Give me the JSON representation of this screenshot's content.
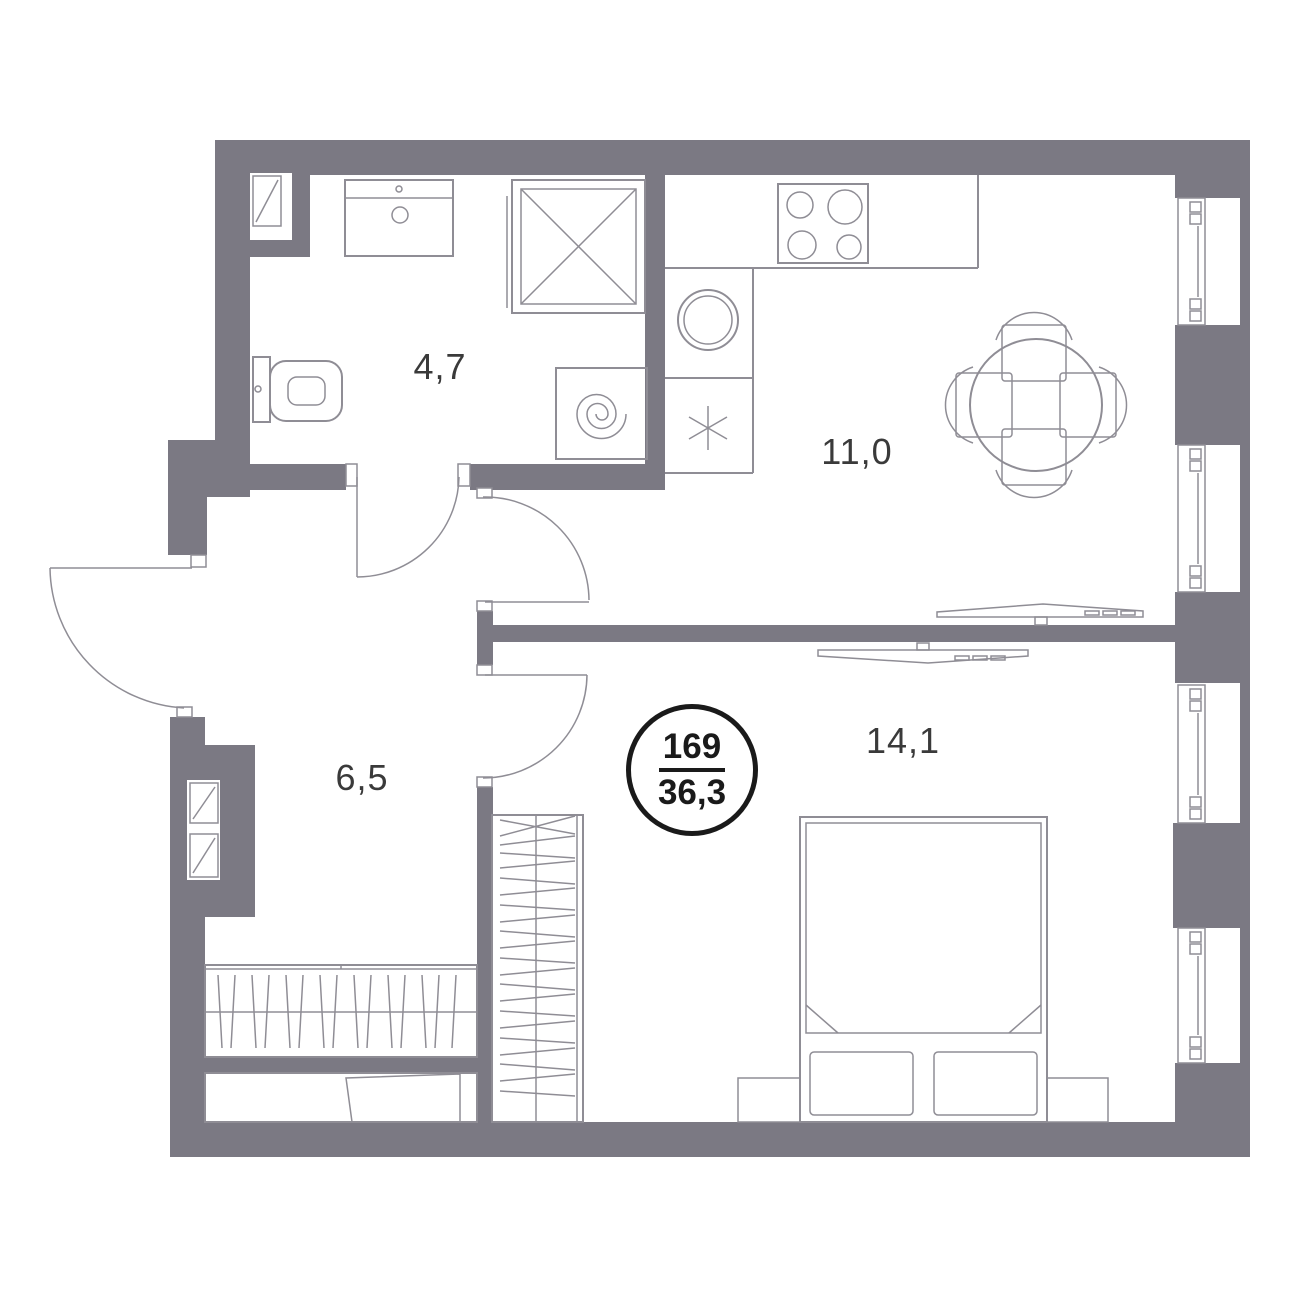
{
  "plan": {
    "badge": {
      "unit_number": "169",
      "total_area": "36,3"
    },
    "rooms": [
      {
        "id": "bathroom",
        "area_label": "4,7"
      },
      {
        "id": "kitchen-living",
        "area_label": "11,0"
      },
      {
        "id": "hallway",
        "area_label": "6,5"
      },
      {
        "id": "bedroom",
        "area_label": "14,1"
      }
    ],
    "fixtures": [
      "sink-icon",
      "shower-icon",
      "toilet-icon",
      "washing-machine-icon",
      "stove-icon",
      "kitchen-sink-icon",
      "fridge-icon",
      "dining-table-icon",
      "tv-icon",
      "bed-icon",
      "pillow-icon",
      "nightstand-icon",
      "wardrobe-icon",
      "closet-icon",
      "shoe-bench-icon",
      "electrical-panel-icon",
      "door-icon",
      "window-icon"
    ],
    "colors": {
      "wall": "#7b7983",
      "furniture_line": "#8f8d95",
      "label_text": "#3a3a3a",
      "badge": "#1a1a1a",
      "background": "#ffffff"
    }
  }
}
